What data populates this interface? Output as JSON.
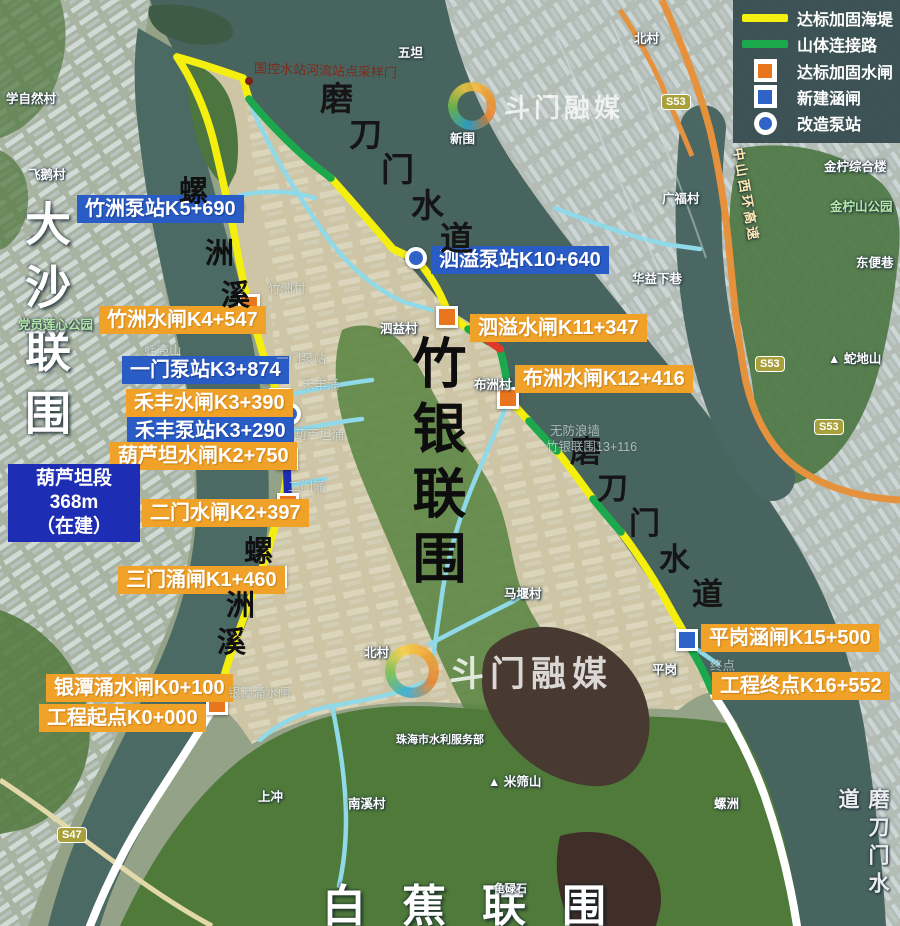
{
  "legend": {
    "items": [
      {
        "label": "达标加固海堤",
        "shape": "line",
        "color": "#f4ef0f"
      },
      {
        "label": "山体连接路",
        "shape": "line",
        "color": "#1ca94d"
      },
      {
        "label": "达标加固水闸",
        "shape": "square",
        "color": "#e8761f"
      },
      {
        "label": "新建涵闸",
        "shape": "square",
        "color": "#2f63c8"
      },
      {
        "label": "改造泵站",
        "shape": "circle",
        "color": "#2f63c8"
      }
    ]
  },
  "callouts": {
    "zhuzhou_pump": "竹洲泵站K5+690",
    "zhuzhou_gate": "竹洲水闸K4+547",
    "yimen_pump": "一门泵站K3+874",
    "hefeng_gate": "禾丰水闸K3+390",
    "hefeng_pump": "禾丰泵站K3+290",
    "hulutan_gate": "葫芦坦水闸K2+750",
    "hulutan_line1": "葫芦坦段368m",
    "hulutan_line2": "（在建）",
    "ermen_gate": "二门水闸K2+397",
    "sanmen_gate": "三门涌闸K1+460",
    "yintan_gate": "银潭涌水闸K0+100",
    "start_point": "工程起点K0+000",
    "siyi_pump": "泗溢泵站K10+640",
    "siyi_gate": "泗溢水闸K11+347",
    "buzhou_gate": "布洲水闸K12+416",
    "pinggang_gate": "平岗涵闸K15+500",
    "end_point": "工程终点K16+552"
  },
  "region_labels": {
    "dasha": "大沙联围",
    "zhuyin": "竹银联围",
    "baijiao": "白蕉联围",
    "modaomen_top": "磨刀门水道",
    "modaomen_mid": "磨刀门水道",
    "modaomen_right": "磨刀门水道",
    "luozhouxi_top": "螺洲溪",
    "luozhouxi_bottom": "螺洲溪"
  },
  "watermark": {
    "text": "斗门融媒"
  },
  "road_shields": {
    "s53": "S53",
    "s47": "S47"
  },
  "map_note": "国控水站河流站点采样门",
  "places": [
    "学自然村",
    "飞鹅村",
    "五坦",
    "新围",
    "北村",
    "广福村",
    "金柠综合楼",
    "金柠山公园",
    "东便巷",
    "华益下巷",
    "▲ 蛇地山",
    "中山西环高速",
    "泗益村",
    "布洲村",
    "竹洲村",
    "马堰村",
    "平岗",
    "终点",
    "无防浪墙",
    "竹银联围13+116",
    "党员莲心公园",
    "蚝壳山",
    "北村",
    "珠海市水利服务部",
    "▲ 米筛山",
    "上冲",
    "南溪村",
    "龟碌石",
    "螺洲",
    "一门泵站",
    "禾丰涌",
    "葫芦坦涌",
    "二门涌",
    "银潭涌水闸"
  ]
}
